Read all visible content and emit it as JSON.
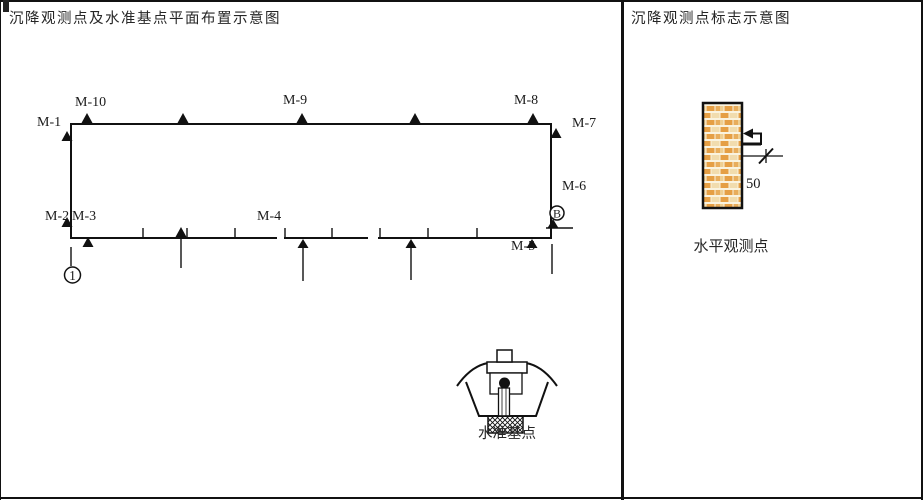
{
  "left_panel": {
    "title": "沉降观测点及水准基点平面布置示意图",
    "point_labels": {
      "m1": "M-1",
      "m2": "M-2",
      "m3": "M-3",
      "m4": "M-4",
      "m5": "M-5",
      "m6": "M-6",
      "m7": "M-7",
      "m8": "M-8",
      "m9": "M-9",
      "m10": "M-10"
    },
    "grid_bubbles": {
      "column": "1",
      "row": "B"
    },
    "benchmark_label": "水准基点"
  },
  "right_panel": {
    "title": "沉降观测点标志示意图",
    "dimension_value": "50",
    "marker_label": "水平观测点"
  },
  "colors": {
    "line": "#111111",
    "text": "#262626",
    "brick_orange": "#e59f45",
    "brick_cream": "#f1dcae",
    "background": "#ffffff"
  }
}
